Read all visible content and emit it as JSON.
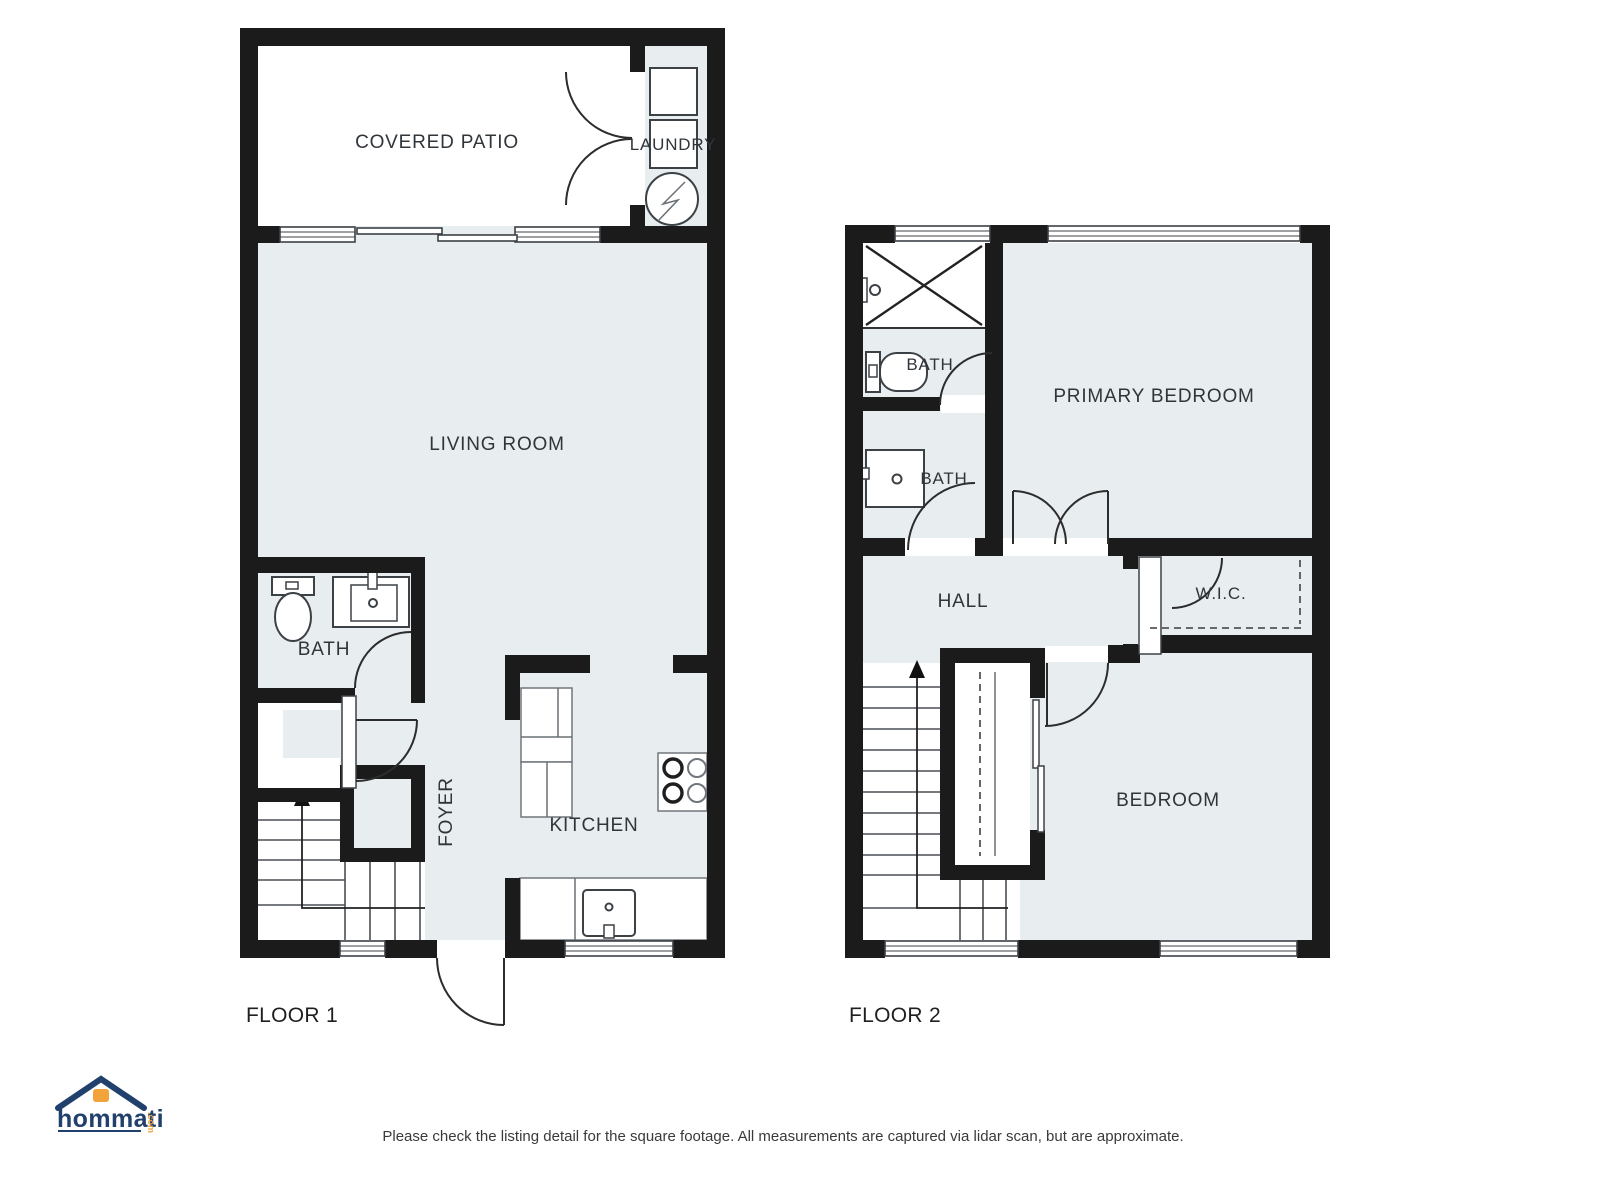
{
  "floor1": {
    "label": "FLOOR 1",
    "rooms": {
      "covered_patio": "COVERED PATIO",
      "laundry": "LAUNDRY",
      "living_room": "LIVING ROOM",
      "bath": "BATH",
      "foyer": "FOYER",
      "kitchen": "KITCHEN"
    }
  },
  "floor2": {
    "label": "FLOOR 2",
    "rooms": {
      "bath_top": "BATH",
      "bath_mid": "BATH",
      "primary_bedroom": "PRIMARY BEDROOM",
      "hall": "HALL",
      "wic": "W.I.C.",
      "bedroom": "BEDROOM"
    }
  },
  "footer": {
    "disclaimer": "Please check the listing detail for the square footage. All measurements are captured via lidar scan, but are approximate."
  },
  "logo": {
    "brand": "hommati",
    "suffix": ".com"
  },
  "colors": {
    "room_fill": "#e8edef",
    "wall": "#1b1b1b",
    "label": "#30353a",
    "logo_navy": "#21406b",
    "logo_orange": "#f2a33c"
  }
}
